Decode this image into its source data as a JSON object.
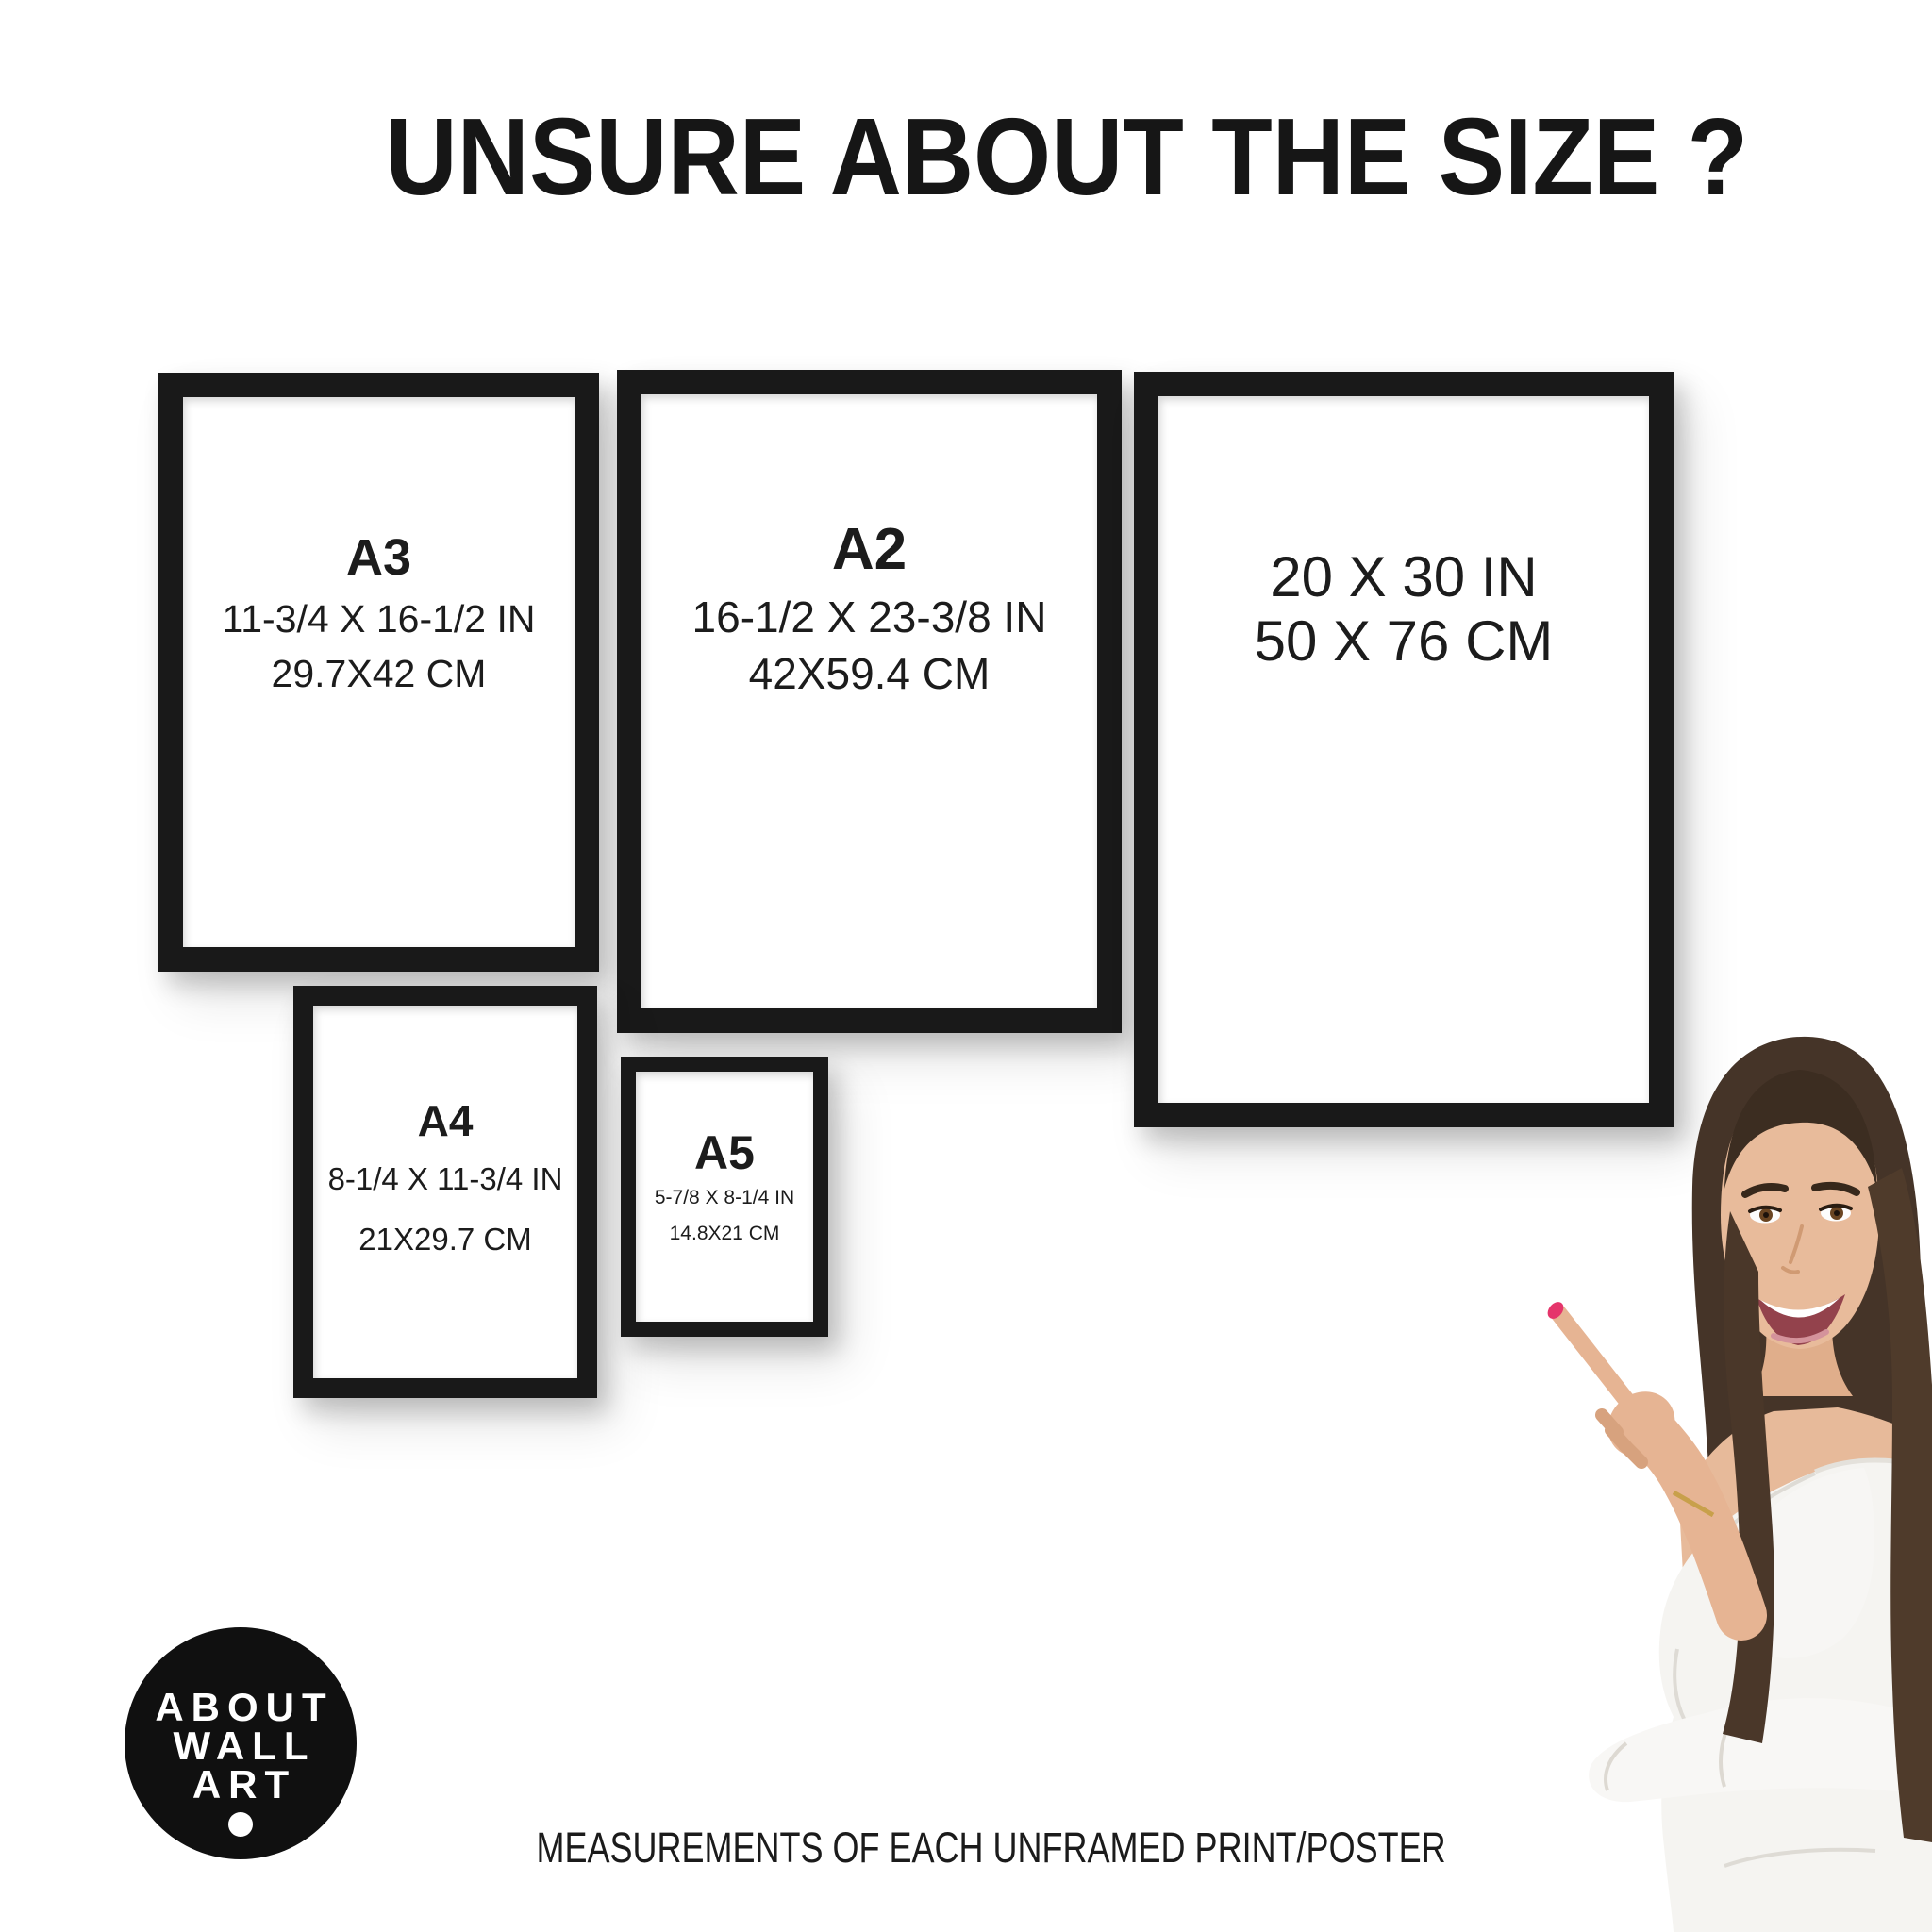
{
  "title": "UNSURE ABOUT THE SIZE ?",
  "caption": "MEASUREMENTS OF EACH UNFRAMED PRINT/POSTER",
  "logo": {
    "lines": [
      "ABOUT",
      "WALL",
      "ART"
    ]
  },
  "frames": [
    {
      "name": "A3",
      "label": "A3",
      "inches": "11-3/4 X 16-1/2 IN",
      "cm": "29.7X42 CM"
    },
    {
      "name": "A2",
      "label": "A2",
      "inches": "16-1/2 X 23-3/8 IN",
      "cm": "42X59.4 CM"
    },
    {
      "name": "20x30",
      "label": "",
      "inches": "20 X 30 IN",
      "cm": "50 X 76 CM"
    },
    {
      "name": "A4",
      "label": "A4",
      "inches": "8-1/4 X 11-3/4 IN",
      "cm": "21X29.7 CM"
    },
    {
      "name": "A5",
      "label": "A5",
      "inches": "5-7/8 X 8-1/4 IN",
      "cm": "14.8X21 CM"
    }
  ],
  "colors": {
    "background": "#ffffff",
    "frame": "#191919",
    "text": "#1d1d1d",
    "logo_bg": "#101010",
    "logo_text": "#ffffff",
    "hair": "#453428",
    "skin": "#e8bb9b",
    "blouse": "#f5f4f1",
    "nail": "#e5356b"
  }
}
